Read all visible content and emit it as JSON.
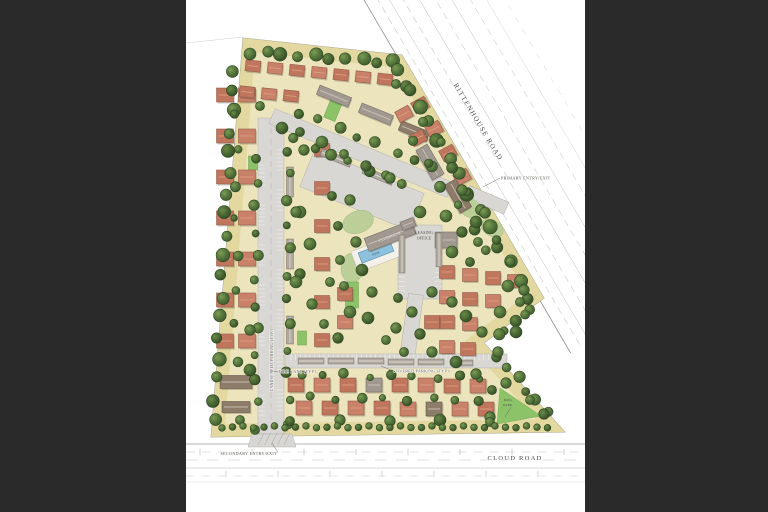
{
  "document_type": "residential community color site plan",
  "labels": {
    "rittenhouse_road": "RITTENHOUSE ROAD",
    "cloud_road": "CLOUD ROAD",
    "primary_entry": "PRIMARY ENTRY/EXIT",
    "secondary_entry": "SECONDARY ENTRY/EXIT",
    "leasing_line1": "LEASING",
    "leasing_line2": "OFFICE",
    "clubhouse": "CLUBHOUSE",
    "pool": "POOL",
    "dog_line1": "DOG",
    "dog_line2": "PARK",
    "covered_parking": "COVERED PARKING (TYP.)",
    "fire_lane": "FIRE LANE (TYP.)",
    "landscaped_parking": "LANDSCAPED PARKING (TYP.)"
  },
  "palette": {
    "background": "#2a2a2a",
    "sheet": "#ffffff",
    "site_tan": "#ece4bd",
    "buffer_tan": "#e3d8a0",
    "road_gray": "#d9d7d3",
    "road_edge": "#aeaca8",
    "line_faint": "#c6c4c0",
    "roof_red": "#c0755d",
    "roof_red_alt": "#c9816a",
    "roof_red_ridge": "#dca183",
    "roof_red_stroke": "#95604c",
    "roof_gray": "#a19890",
    "roof_gray_stroke": "#776f69",
    "roof_brown": "#8d7c6a",
    "roof_brown_stroke": "#675a4b",
    "carport_gray": "#b0a9a0",
    "carport_stroke": "#7a736b",
    "tree_dark": "#3f5a2e",
    "tree_mid": "#55763c",
    "tree_light": "#7d9c55",
    "lawn_sage": "#bccf99",
    "lawn_bright": "#8cc368",
    "pool_blue": "#8ec1de",
    "pool_deck": "#f3f1ea",
    "text_ink": "#4c4a44"
  }
}
